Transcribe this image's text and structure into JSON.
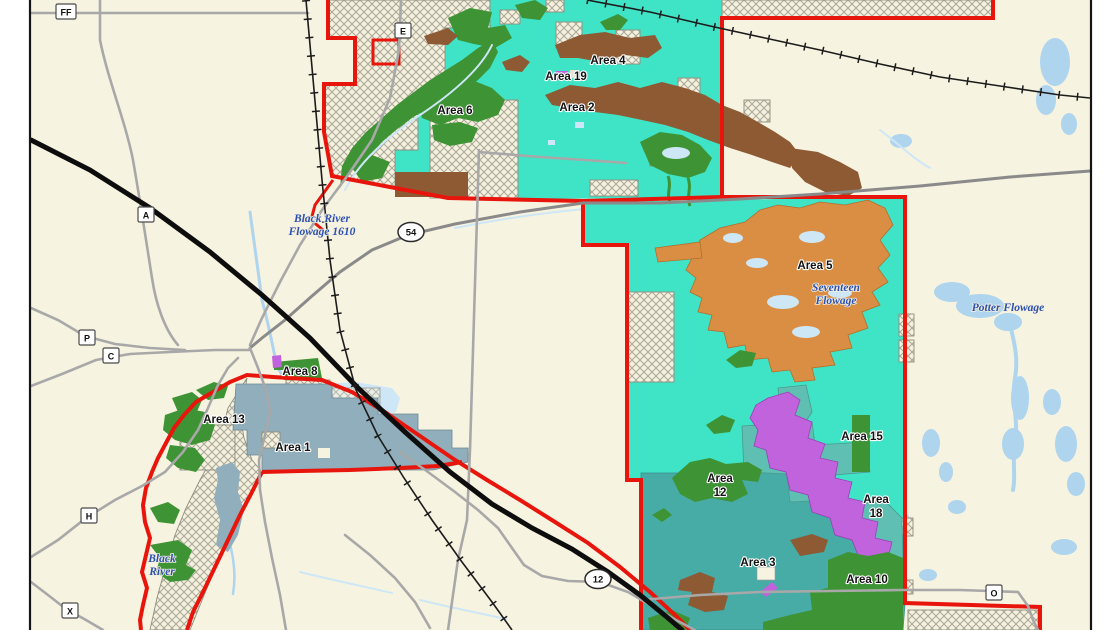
{
  "map": {
    "title": "Wildlife management area map",
    "colors": {
      "cream": "#f7f3e1",
      "teal_bright": "#3fe3c6",
      "teal_muted": "#47aba6",
      "teal_gray": "#5fbfb2",
      "bluegray": "#90aebb",
      "purple": "#c263de",
      "orange": "#d98e43",
      "brown": "#8d5a33",
      "green": "#3e9334",
      "red": "#e8150c",
      "water": "#aed4ee",
      "water_light": "#cde7f7",
      "road_gray": "#a8a8a8",
      "road_dark": "#8a8a8a",
      "rail": "#1c1c1c",
      "label": "#121212",
      "water_label": "#2d51b0",
      "frame": "#151515"
    },
    "region_labels": [
      {
        "name": "area-6",
        "lines": [
          "Area 6"
        ],
        "x": 455,
        "y": 114
      },
      {
        "name": "area-4",
        "lines": [
          "Area 4"
        ],
        "x": 608,
        "y": 64
      },
      {
        "name": "area-19",
        "lines": [
          "Area 19"
        ],
        "x": 566,
        "y": 80
      },
      {
        "name": "area-2",
        "lines": [
          "Area 2"
        ],
        "x": 577,
        "y": 111
      },
      {
        "name": "area-5",
        "lines": [
          "Area 5"
        ],
        "x": 815,
        "y": 269
      },
      {
        "name": "area-15",
        "lines": [
          "Area 15"
        ],
        "x": 862,
        "y": 440
      },
      {
        "name": "area-18",
        "lines": [
          "Area",
          "18"
        ],
        "x": 876,
        "y": 503
      },
      {
        "name": "area-12",
        "lines": [
          "Area",
          "12"
        ],
        "x": 720,
        "y": 482
      },
      {
        "name": "area-3",
        "lines": [
          "Area 3"
        ],
        "x": 758,
        "y": 566
      },
      {
        "name": "area-10",
        "lines": [
          "Area 10"
        ],
        "x": 867,
        "y": 583
      },
      {
        "name": "area-1",
        "lines": [
          "Area 1"
        ],
        "x": 293,
        "y": 451
      },
      {
        "name": "area-13",
        "lines": [
          "Area 13"
        ],
        "x": 224,
        "y": 423
      },
      {
        "name": "area-8",
        "lines": [
          "Area 8"
        ],
        "x": 300,
        "y": 375
      }
    ],
    "water_labels": [
      {
        "name": "black-river-flowage",
        "lines": [
          "Black River",
          "Flowage 1610"
        ],
        "x": 322,
        "y": 222
      },
      {
        "name": "seventeen-flowage",
        "lines": [
          "Seventeen",
          "Flowage"
        ],
        "x": 836,
        "y": 291
      },
      {
        "name": "potter-flowage",
        "lines": [
          "Potter Flowage"
        ],
        "x": 1008,
        "y": 311
      },
      {
        "name": "black-river",
        "lines": [
          "Black",
          "River"
        ],
        "x": 162,
        "y": 562
      }
    ],
    "road_markers": [
      {
        "label": "FF",
        "x": 66,
        "y": 12
      },
      {
        "label": "E",
        "x": 403,
        "y": 31
      },
      {
        "label": "A",
        "x": 146,
        "y": 215
      },
      {
        "label": "P",
        "x": 87,
        "y": 338
      },
      {
        "label": "C",
        "x": 111,
        "y": 356
      },
      {
        "label": "H",
        "x": 89,
        "y": 516
      },
      {
        "label": "X",
        "x": 70,
        "y": 611
      },
      {
        "label": "O",
        "x": 994,
        "y": 593
      }
    ],
    "route_shields": [
      {
        "number": "54",
        "x": 411,
        "y": 232
      },
      {
        "number": "12",
        "x": 598,
        "y": 579
      }
    ]
  }
}
